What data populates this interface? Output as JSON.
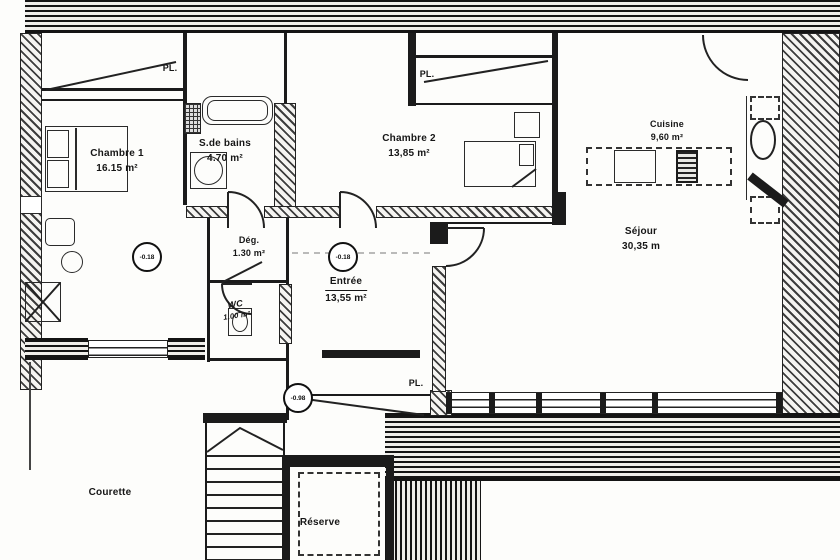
{
  "rooms": {
    "chambre1": {
      "name": "Chambre 1",
      "area": "16.15 m²"
    },
    "sdb": {
      "name": "S.de bains",
      "area": "4.70 m²"
    },
    "chambre2": {
      "name": "Chambre 2",
      "area": "13,85 m²"
    },
    "cuisine": {
      "name": "Cuisine",
      "area": "9,60 m²"
    },
    "sejour": {
      "name": "Séjour",
      "area": "30,35 m"
    },
    "degagement": {
      "name": "Dég.",
      "area": "1.30 m²"
    },
    "entree": {
      "name": "Entrée",
      "area": "13,55 m²"
    },
    "wc": {
      "name": "WC",
      "area": "1.00 m²"
    },
    "reserve": {
      "name": "Réserve"
    },
    "courette": {
      "name": "Courette"
    }
  },
  "labels": {
    "closet": "PL."
  },
  "levels": {
    "hall": "-0.18",
    "entree": "-0.18",
    "lower": "-0.98"
  },
  "colors": {
    "ink": "#1b1b1b",
    "paper": "#fdfdfb"
  }
}
